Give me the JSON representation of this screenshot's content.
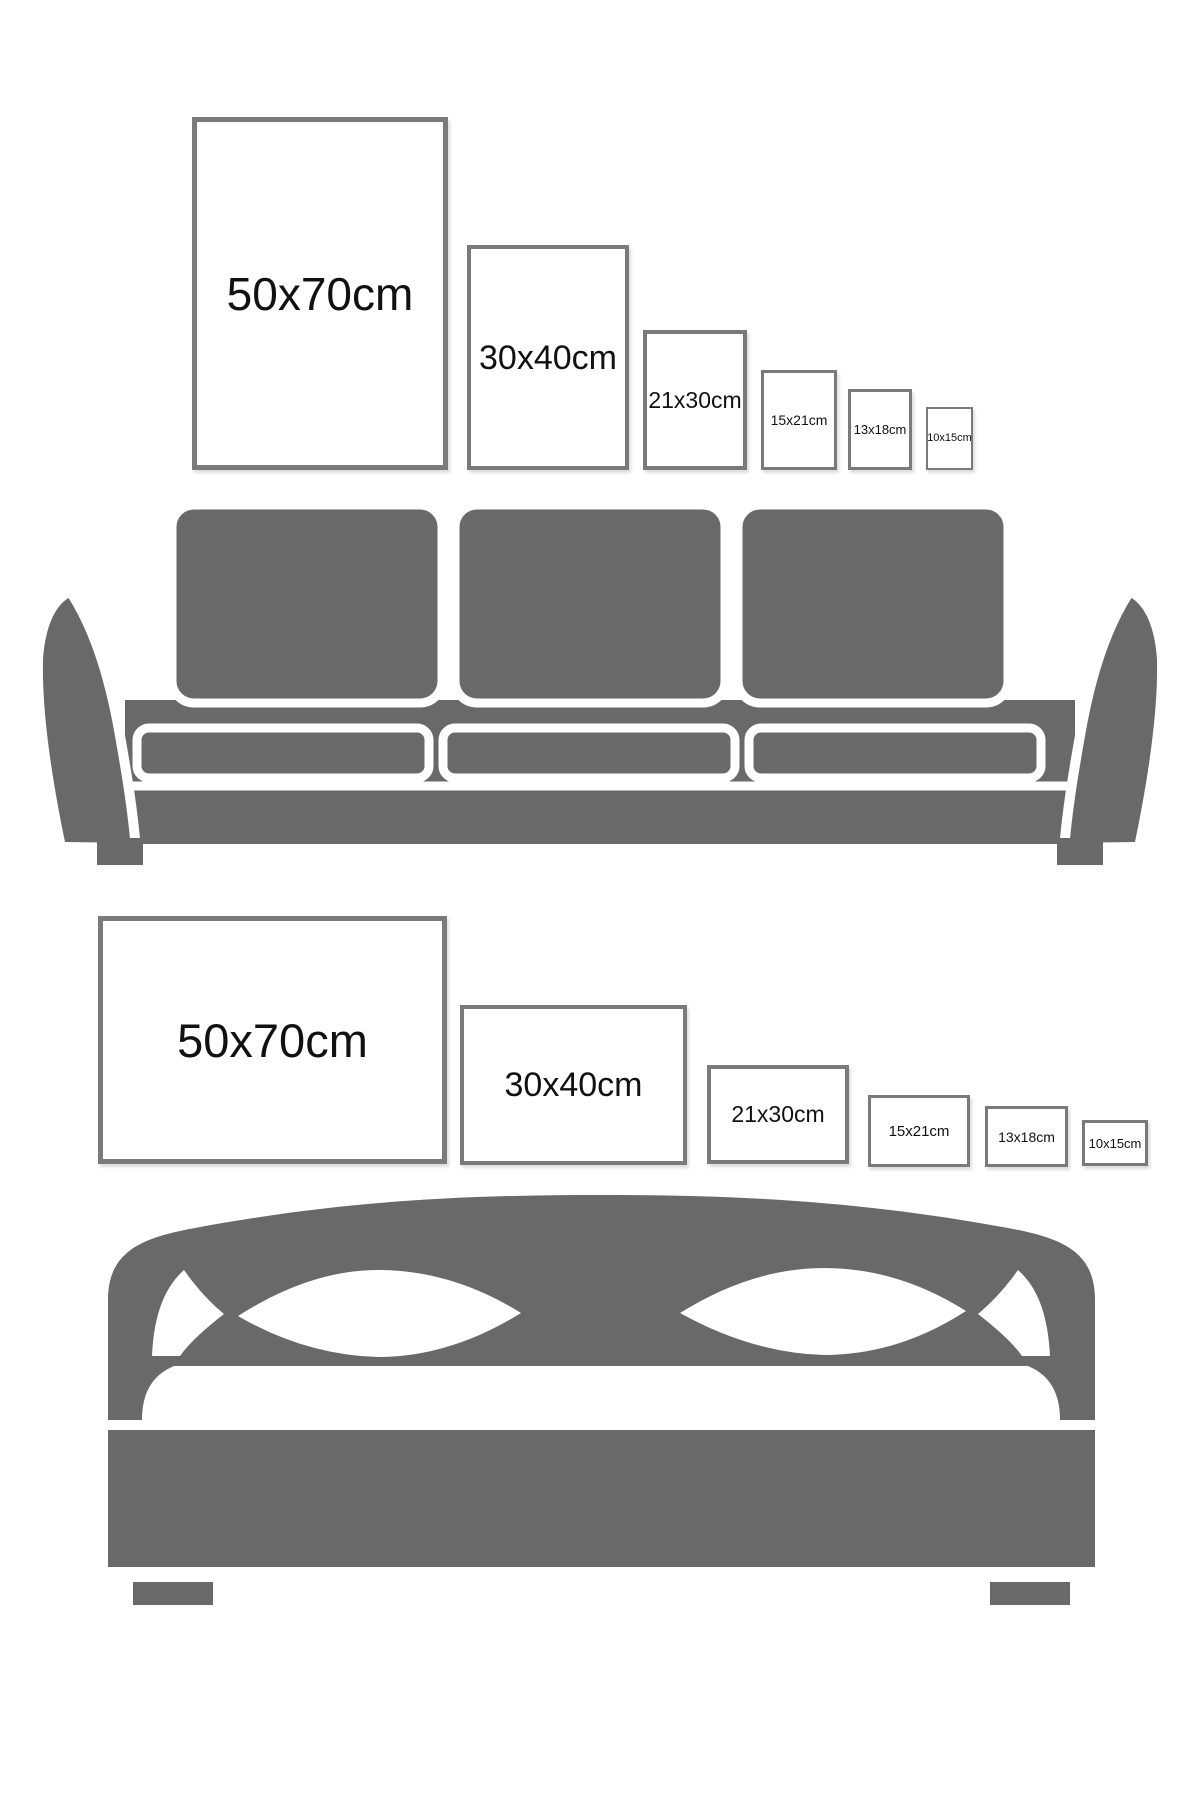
{
  "colors": {
    "background": "#ffffff",
    "furniture_gray": "#696969",
    "frame_border": "#7a7a7a",
    "label_text": "#111111"
  },
  "sizes": [
    "50x70cm",
    "30x40cm",
    "21x30cm",
    "15x21cm",
    "13x18cm",
    "10x15cm"
  ],
  "top_section": {
    "furniture": "sofa",
    "orientation": "portrait",
    "frames": [
      {
        "label": "50x70cm"
      },
      {
        "label": "30x40cm"
      },
      {
        "label": "21x30cm"
      },
      {
        "label": "15x21cm"
      },
      {
        "label": "13x18cm"
      },
      {
        "label": "10x15cm"
      }
    ]
  },
  "bottom_section": {
    "furniture": "bed",
    "orientation": "landscape",
    "frames": [
      {
        "label": "50x70cm"
      },
      {
        "label": "30x40cm"
      },
      {
        "label": "21x30cm"
      },
      {
        "label": "15x21cm"
      },
      {
        "label": "13x18cm"
      },
      {
        "label": "10x15cm"
      }
    ]
  }
}
